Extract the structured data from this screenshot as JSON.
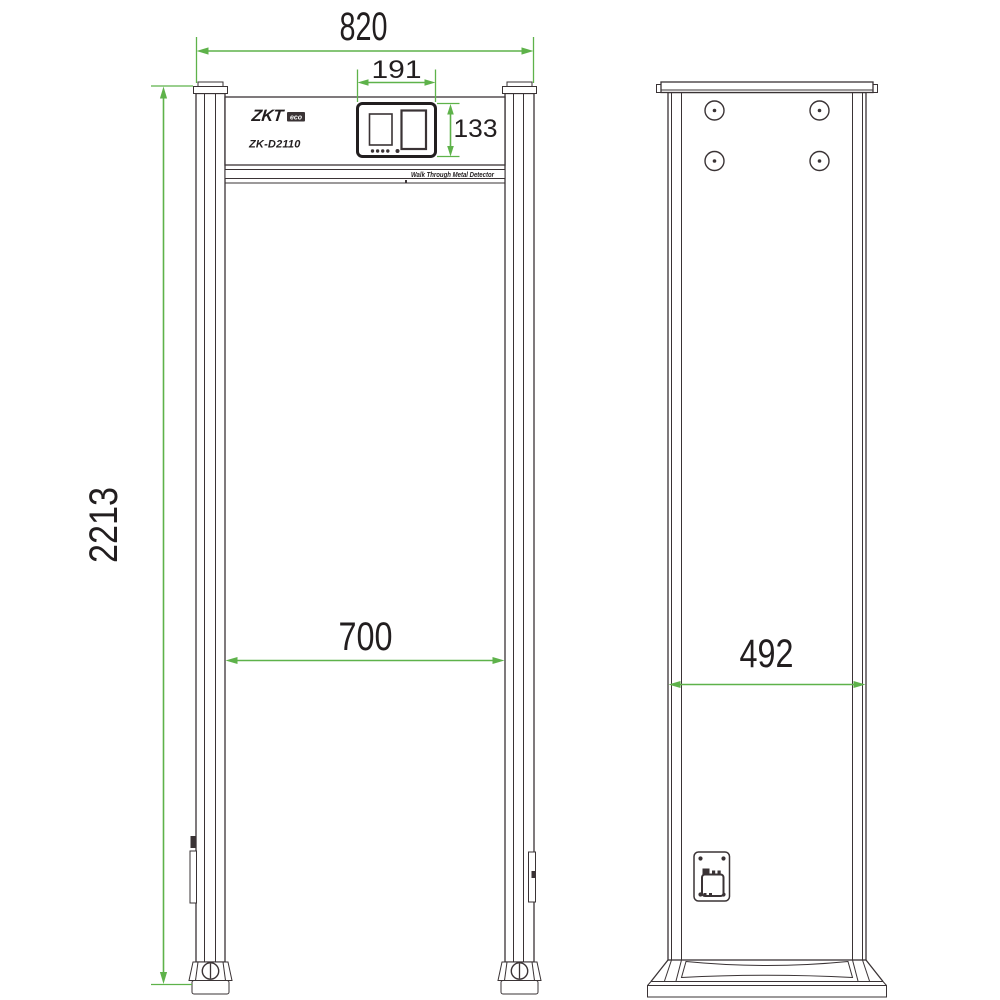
{
  "drawing": {
    "brand": "ZKT",
    "brand_suffix": "eco",
    "model": "ZK-D2110",
    "product_label": "Walk Through Metal Detector",
    "dimensions_mm": {
      "overall_width": "820",
      "control_panel_width": "191",
      "control_panel_height": "133",
      "overall_height": "2213",
      "tunnel_inner_width": "700",
      "side_depth": "492"
    },
    "colors": {
      "dimension_green": "#5eb24a",
      "line_dark": "#3a3335",
      "text_dark": "#221e1f"
    }
  }
}
